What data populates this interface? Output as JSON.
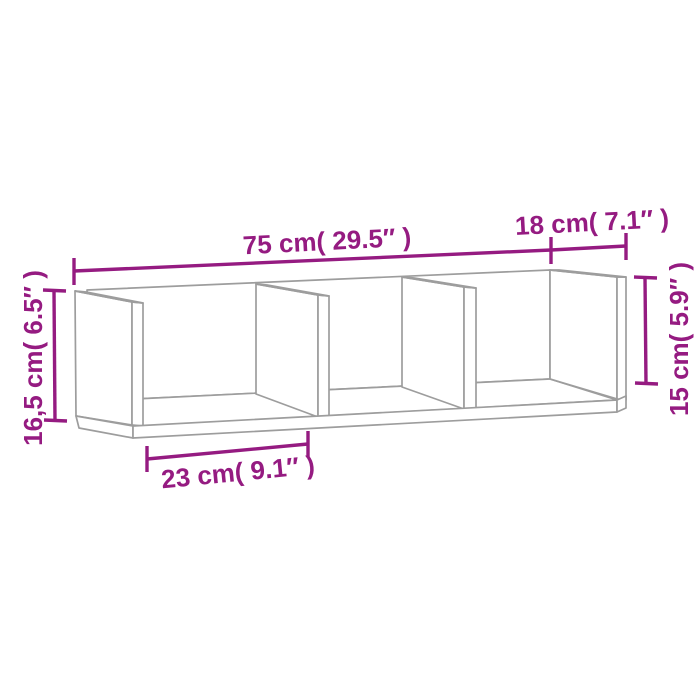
{
  "diagram": {
    "type": "furniture-dimension-diagram",
    "subject": "wall shelf with 3 open compartments",
    "colors": {
      "dimension_lines": "#951b81",
      "drawing_lines": "#9d9d9d",
      "background": "#ffffff"
    },
    "dimensions": {
      "width": {
        "cm": "75",
        "inch": "29.5",
        "label": "75 cm( 29.5″ )"
      },
      "depth": {
        "cm": "18",
        "inch": "7.1",
        "label": "18 cm( 7.1″ )"
      },
      "height_total": {
        "cm": "16,5",
        "inch": "6.5",
        "label": "16,5 cm( 6.5″ )"
      },
      "height_inner": {
        "cm": "15",
        "inch": "5.9",
        "label": "15 cm( 5.9″ )"
      },
      "compartment_width": {
        "cm": "23",
        "inch": "9.1",
        "label": "23 cm( 9.1″ )"
      }
    }
  }
}
